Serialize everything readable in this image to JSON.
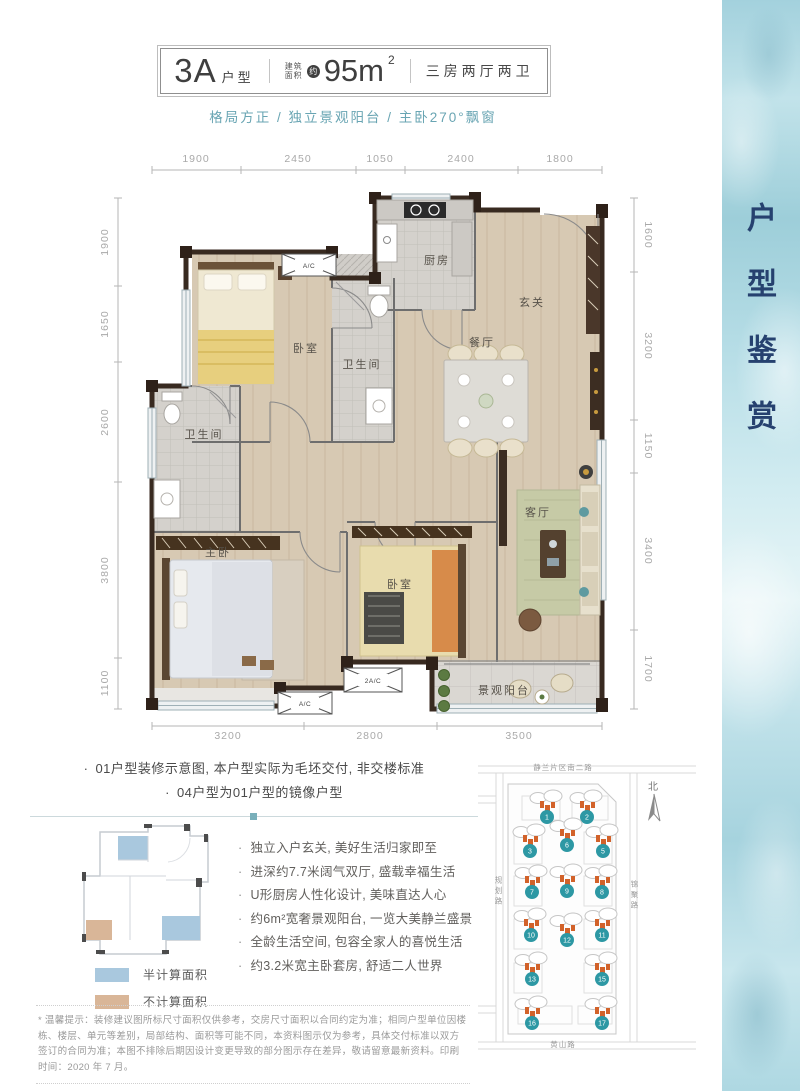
{
  "header": {
    "unit_code": "3A",
    "unit_code_suffix": "户型",
    "area_prefix_top": "建筑",
    "area_prefix_bottom": "面积",
    "area_approx_badge": "约",
    "area_value": "95m",
    "area_exponent": "2",
    "room_config": "三房两厅两卫"
  },
  "subtitle": "格局方正 / 独立景观阳台 / 主卧270°飘窗",
  "sidebar": {
    "title": "户型鉴赏"
  },
  "plan": {
    "dims": {
      "top": [
        "1900",
        "2450",
        "1050",
        "2400",
        "1800"
      ],
      "left": [
        "1900",
        "1650",
        "2600",
        "3800",
        "1100"
      ],
      "right": [
        "1600",
        "3200",
        "1150",
        "3400",
        "1700"
      ],
      "bottom": [
        "3200",
        "2800",
        "3500"
      ]
    },
    "rooms": {
      "kitchen": "厨房",
      "entry": "玄关",
      "dining": "餐厅",
      "bedroom2": "卧室",
      "bath2": "卫生间",
      "bath1": "卫生间",
      "master": "主卧",
      "bedroom3": "卧室",
      "living": "客厅",
      "balcony": "景观阳台"
    },
    "ac": [
      "A/C",
      "2A/C",
      "A/C"
    ]
  },
  "notes": [
    "01户型装修示意图, 本户型实际为毛坯交付, 非交楼标准",
    "04户型为01户型的镜像户型"
  ],
  "mini_plan_legend": {
    "half": "半计算面积",
    "excluded": "不计算面积"
  },
  "features": [
    "独立入户玄关, 美好生活归家即至",
    "进深约7.7米阔气双厅, 盛载幸福生活",
    "U形厨房人性化设计, 美味直达人心",
    "约6m²宽奢景观阳台, 一览大美静兰盛景",
    "全龄生活空间, 包容全家人的喜悦生活",
    "约3.2米宽主卧套房, 舒适二人世界"
  ],
  "site_map": {
    "road_top": "静兰片区南二路",
    "road_bottom": "黄山路",
    "road_left": "规划路",
    "road_right": "锦聚路",
    "north_label": "北",
    "buildings": [
      "1",
      "2",
      "3",
      "6",
      "5",
      "7",
      "9",
      "8",
      "10",
      "12",
      "11",
      "13",
      "15",
      "16",
      "17"
    ]
  },
  "disclaimer": "* 温馨提示：装修建议图所标尺寸面积仅供参考，交房尺寸面积以合同约定为准；相同户型单位因楼栋、楼层、单元等差别，局部结构、面积等可能不同，本资料图示仅为参考，具体交付标准以双方签订的合同为准；本图不排除后期因设计变更导致的部分图示存在差异，敬请留意最新资料。印刷时间：2020 年 7 月。",
  "colors": {
    "accent_teal": "#69a5b3",
    "sidebar_navy": "#26416f",
    "map_marker_teal": "#2d98a4",
    "building_orange": "#d2622a",
    "legend_half_blue": "#a9c8de",
    "legend_excluded_tan": "#d9b698"
  }
}
